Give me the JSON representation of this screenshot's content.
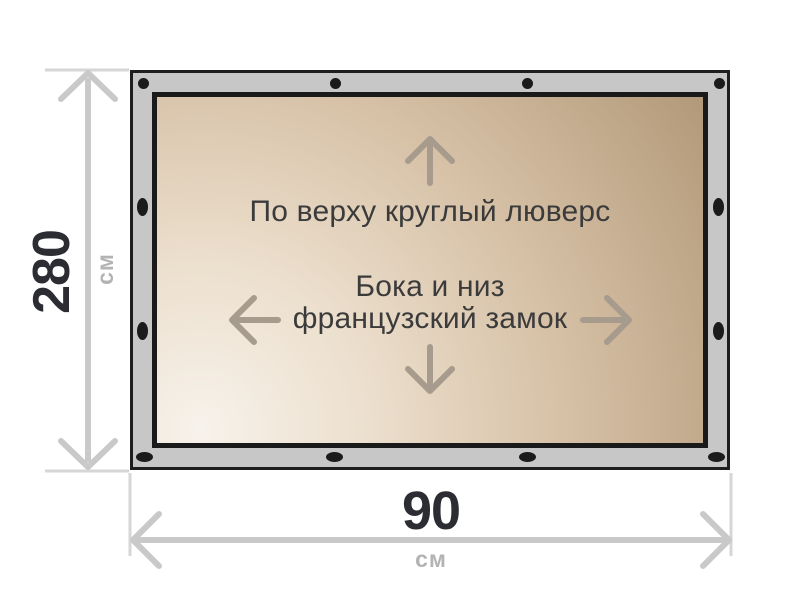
{
  "panel": {
    "top_note": "По верху круглый люверс",
    "sides_note_line1": "Бока и низ",
    "sides_note_line2": "французский замок"
  },
  "dimensions": {
    "height": {
      "value": "280",
      "unit": "см"
    },
    "width": {
      "value": "90",
      "unit": "см"
    }
  },
  "grommets": {
    "top_type": "round-grommet",
    "sides_bottom_type": "oval-grommet",
    "counts": {
      "top": 4,
      "bottom": 4,
      "left": 2,
      "right": 2
    }
  },
  "icons": [
    "arrow-up-icon",
    "arrow-down-icon",
    "arrow-left-icon",
    "arrow-right-icon",
    "height-dimension-arrow",
    "width-dimension-arrow"
  ],
  "colors": {
    "background": "#ffffff",
    "frame_fill": "#c7c7c7",
    "frame_border": "#1e1e1e",
    "panel_border": "#1a1a1a",
    "panel_gradient_light": "#f7f2eb",
    "panel_gradient_dark": "#b29979",
    "panel_text": "#3b3b3b",
    "panel_arrow": "#a69b8c",
    "grommet": "#1b1b1b",
    "dimension_line": "#c9c9c9",
    "dimension_tick": "#d6d6d6",
    "dimension_value_text": "#2b2d33",
    "dimension_unit_text": "#b3b3b3"
  }
}
